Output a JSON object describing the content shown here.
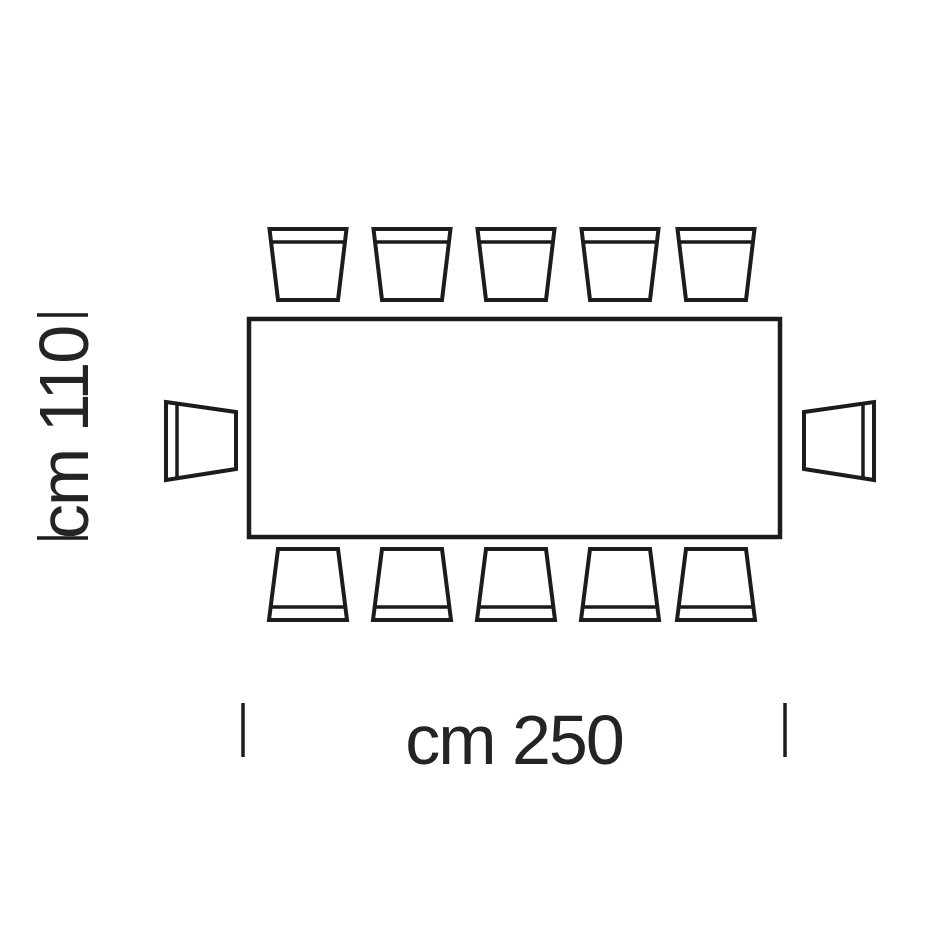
{
  "diagram": {
    "kind": "furniture-dimension-drawing-top-view",
    "table": {
      "shape": "rectangle",
      "width_label": "cm 250",
      "depth_label": "cm 110"
    },
    "seating": {
      "top": 5,
      "bottom": 5,
      "left": 1,
      "right": 1,
      "total": 12
    },
    "colors": {
      "line": "#1c1c1c",
      "text": "#242424",
      "background": "#ffffff"
    }
  }
}
